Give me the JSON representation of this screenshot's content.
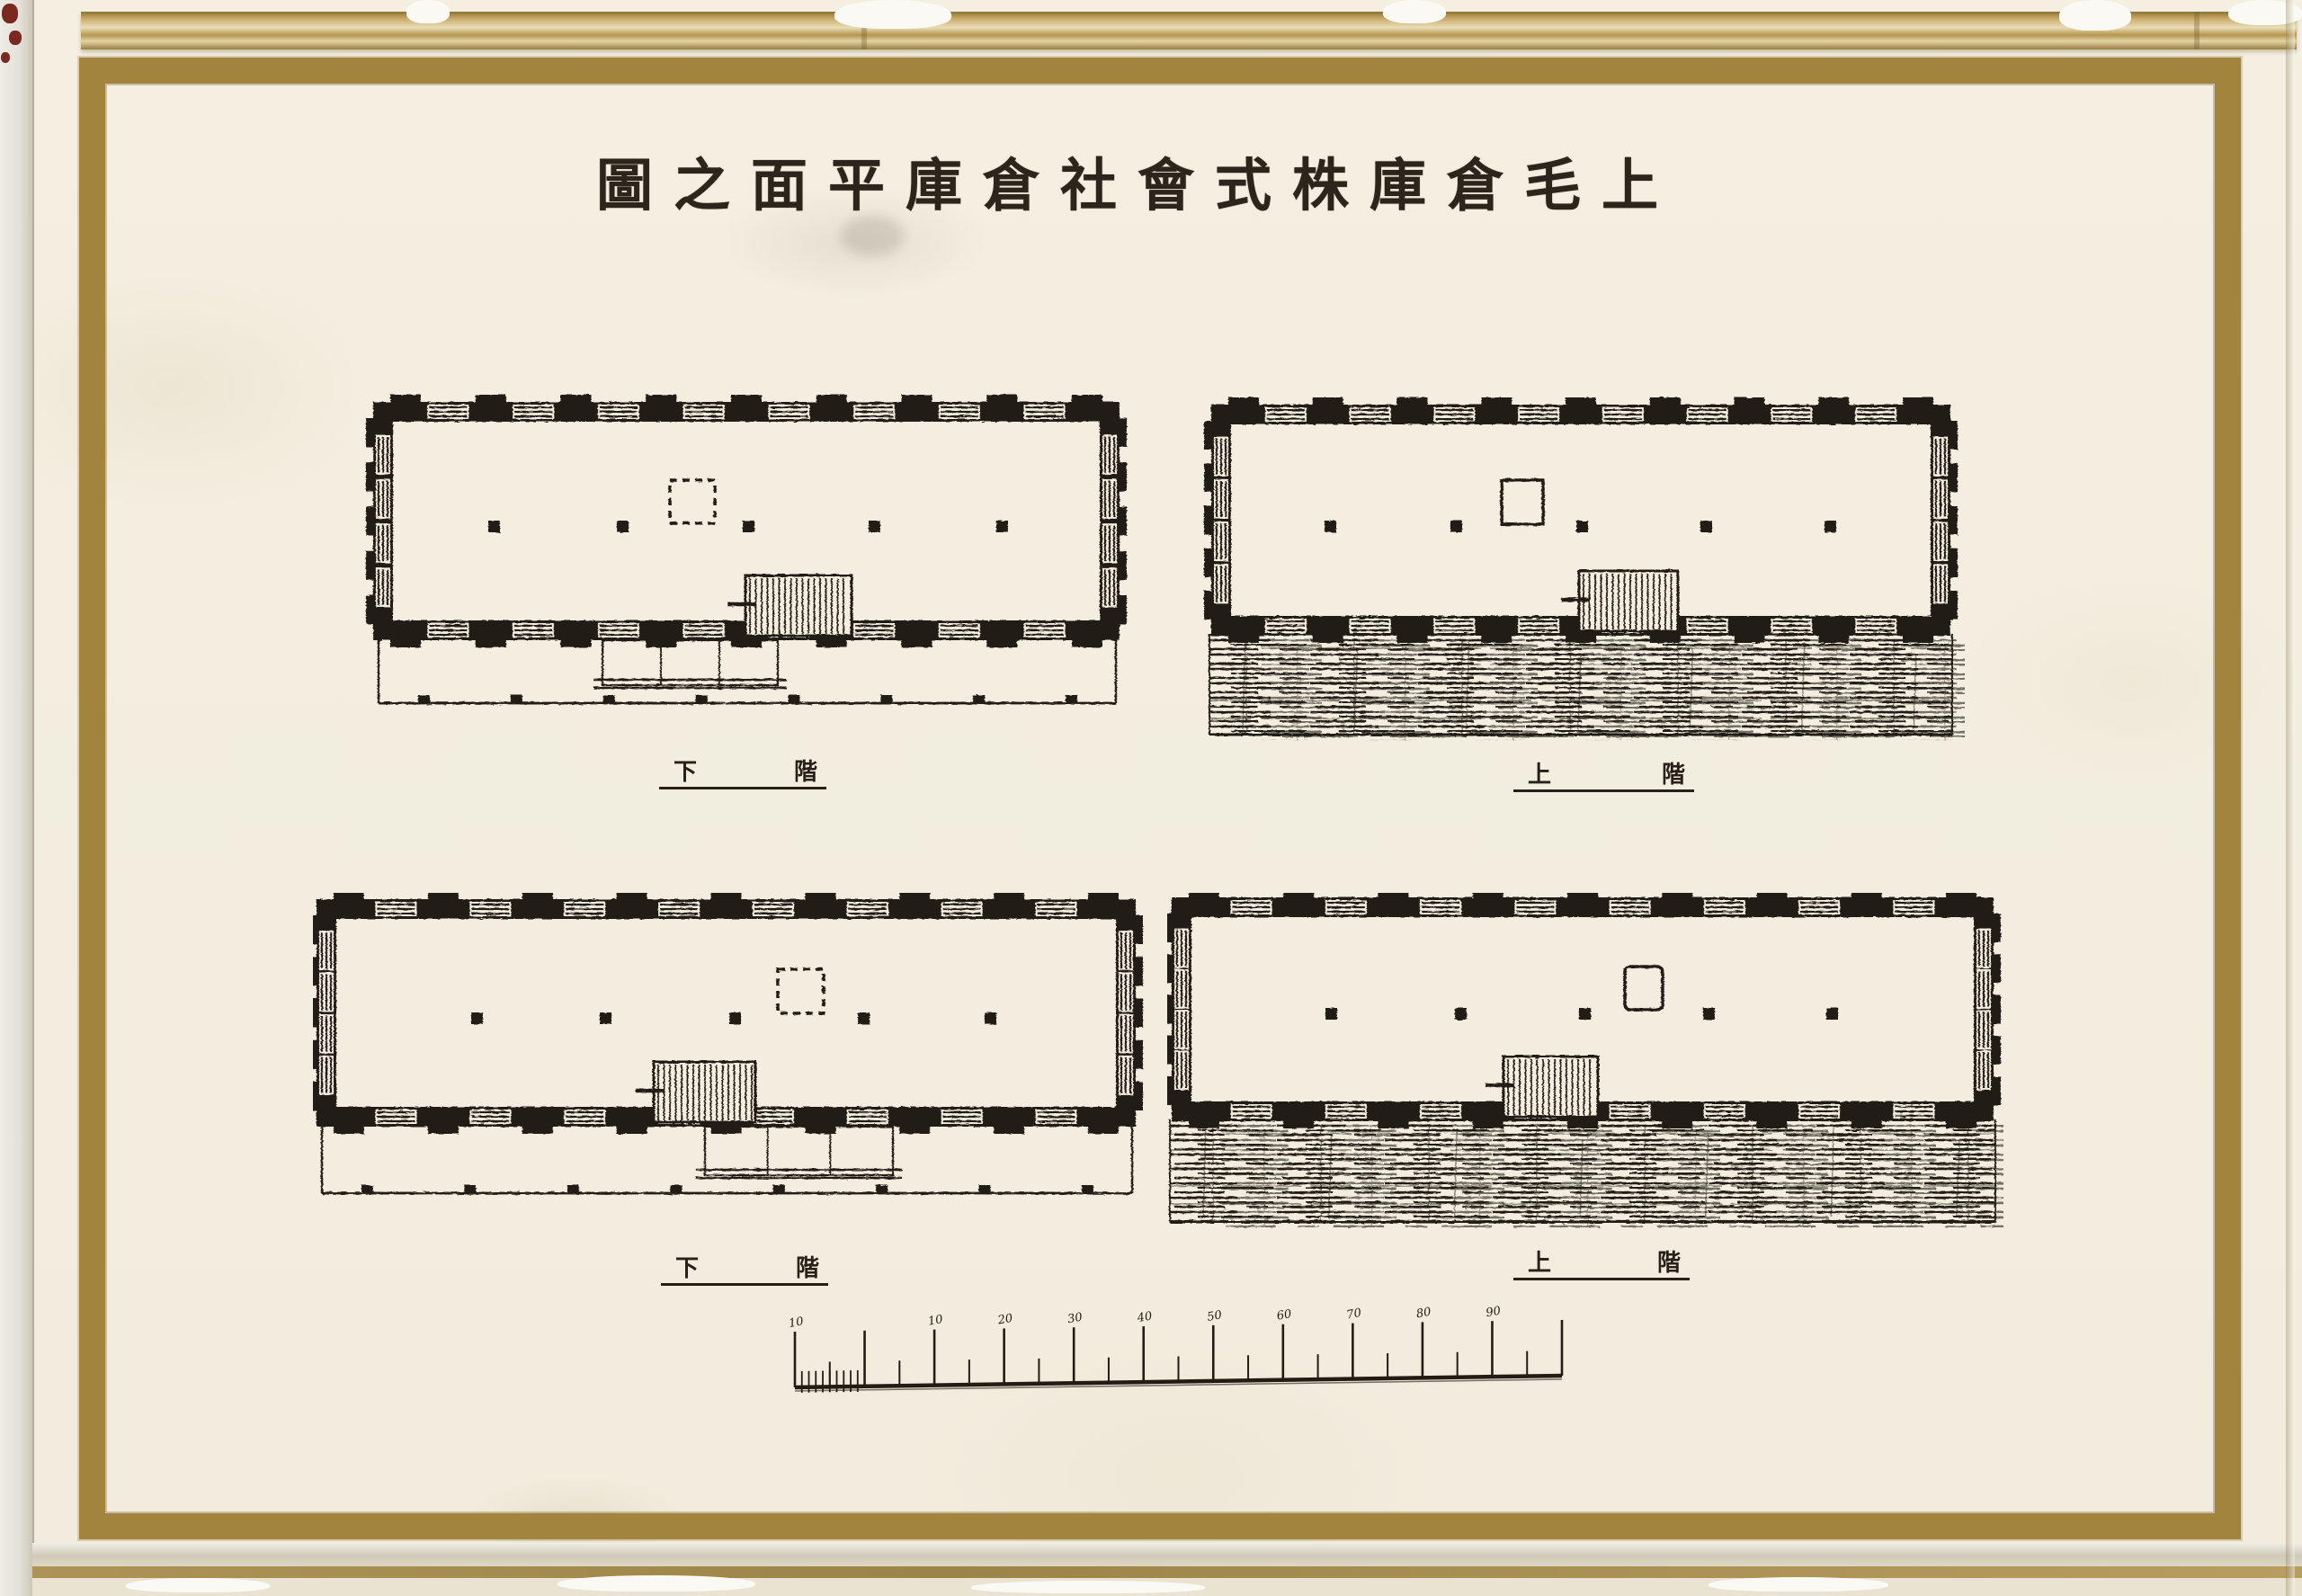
{
  "page_title": {
    "display_text": "圖之面平庫倉社會式株庫倉毛上"
  },
  "plans": [
    {
      "name": "upper-left-plan",
      "floor_label": {
        "left_char": "下",
        "right_char": "階"
      },
      "shaft_style": "dashed",
      "dock_style": "open-platform"
    },
    {
      "name": "upper-right-plan",
      "floor_label": {
        "left_char": "上",
        "right_char": "階"
      },
      "shaft_style": "solid",
      "dock_style": "hatched-roof"
    },
    {
      "name": "lower-left-plan",
      "floor_label": {
        "left_char": "下",
        "right_char": "階"
      },
      "shaft_style": "dashed",
      "dock_style": "open-platform"
    },
    {
      "name": "lower-right-plan",
      "floor_label": {
        "left_char": "上",
        "right_char": "階"
      },
      "shaft_style": "solid",
      "dock_style": "hatched-roof"
    }
  ],
  "scale_bar": {
    "tick_labels": [
      "10",
      "",
      "10",
      "20",
      "30",
      "40",
      "50",
      "60",
      "70",
      "80",
      "90",
      ""
    ]
  },
  "colors": {
    "paper": "#f3eee0",
    "ink": "#221c14",
    "gold_frame": "#a2843c",
    "gilt_edge": "#c9ae6d"
  }
}
